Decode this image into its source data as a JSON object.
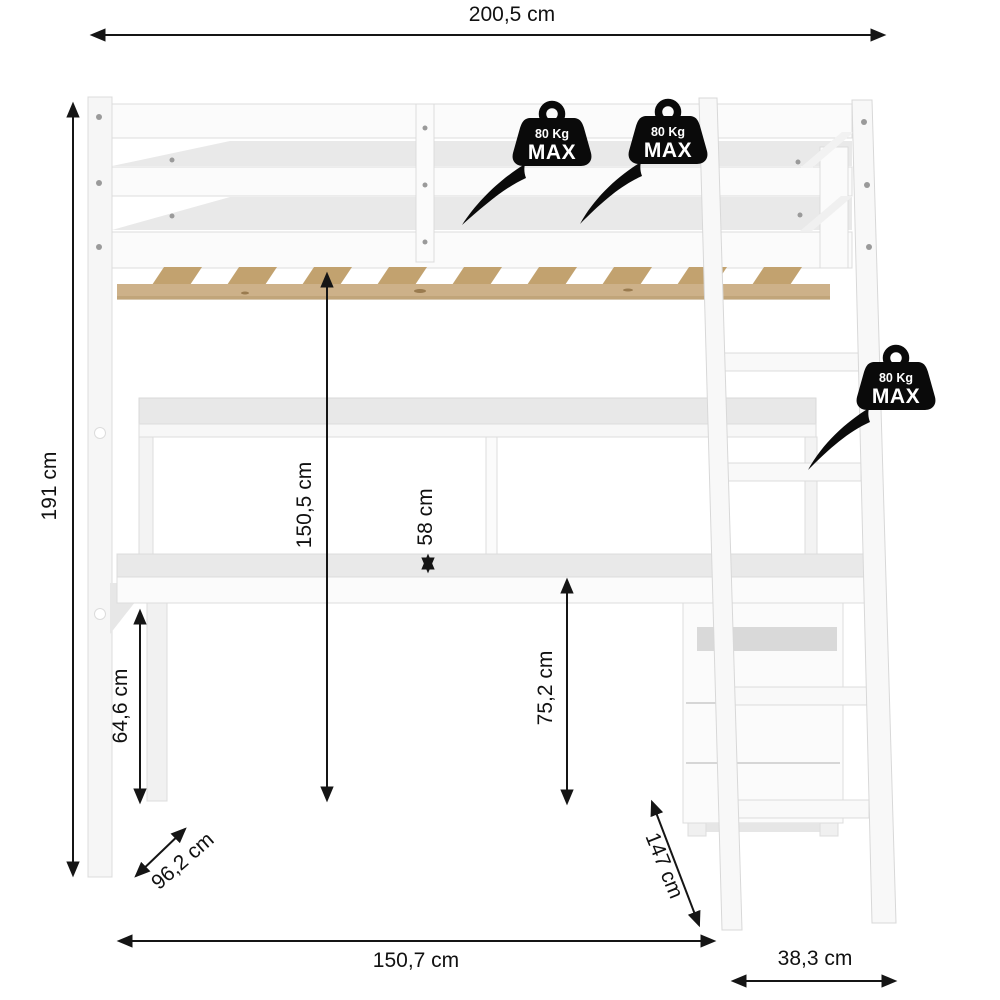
{
  "diagram": {
    "kind": "furniture-dimension-diagram",
    "dimensions": {
      "width_total": "200,5 cm",
      "height_total": "191 cm",
      "under_bed_clearance": "150,5 cm",
      "shelf_gap": "58 cm",
      "desk_surface_height": "75,2 cm",
      "desk_leg_height": "64,6 cm",
      "bed_depth": "96,2 cm",
      "ladder_length": "147 cm",
      "desk_width": "150,7 cm",
      "ladder_footprint_depth": "38,3 cm"
    },
    "badge": {
      "weight": "80 Kg",
      "max": "MAX"
    },
    "colors": {
      "annotation": "#111111",
      "badge": "#0a0a0a",
      "furniture_face": "#fbfbfb",
      "furniture_shade": "#e9e9e9",
      "furniture_edge": "#dcdcdc",
      "slats": "#c2a26f",
      "wood_rail": "#cdb189"
    }
  }
}
